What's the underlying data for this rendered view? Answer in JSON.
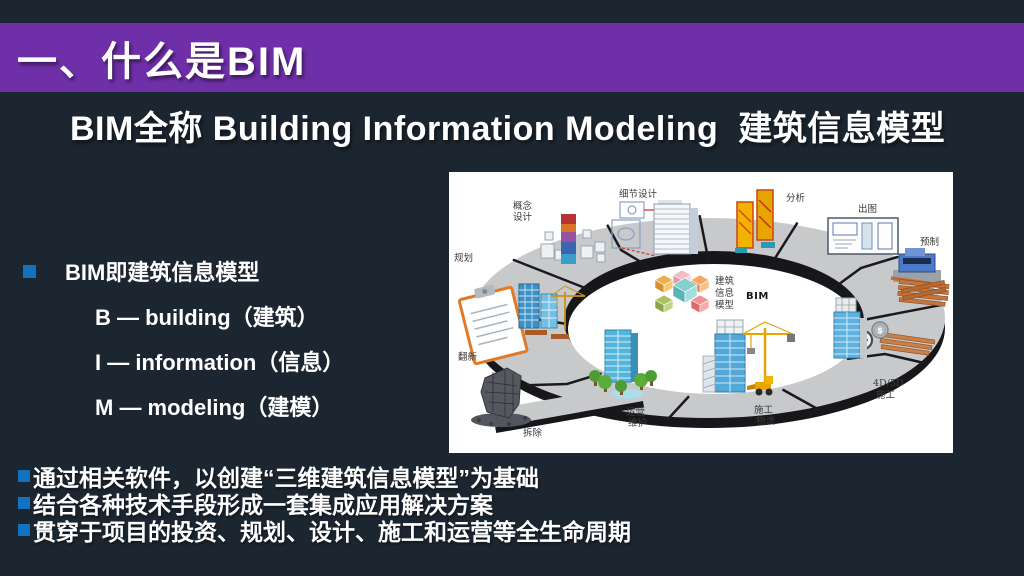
{
  "slide": {
    "title": "一、什么是BIM",
    "subtitle": "BIM全称 Building Information Modeling  建筑信息模型",
    "definition": {
      "heading": "BIM即建筑信息模型",
      "items": [
        "B — building（建筑）",
        "I — information（信息）",
        "M — modeling（建模）"
      ]
    },
    "summary_bullets": [
      "通过相关软件，以创建“三维建筑信息模型”为基础",
      "结合各种技术手段形成一套集成应用解决方案",
      "贯穿于项目的投资、规划、设计、施工和运营等全生命周期"
    ],
    "colors": {
      "header_purple": "#6f2fa8",
      "bullet_blue": "#1272c2",
      "background": "#1c2630"
    }
  },
  "diagram": {
    "description": "BIM lifecycle ring",
    "center": {
      "lines": [
        "建筑",
        "信息",
        "模型"
      ],
      "caption": "BIM"
    },
    "icons": {
      "dollar": "$"
    },
    "stations": [
      {
        "name": "planning",
        "lines": [
          "规划"
        ]
      },
      {
        "name": "concept-design",
        "lines": [
          "概念",
          "设计"
        ]
      },
      {
        "name": "detail-design",
        "lines": [
          "细节设计"
        ]
      },
      {
        "name": "analysis",
        "lines": [
          "分析"
        ]
      },
      {
        "name": "documentation",
        "lines": [
          "出图"
        ]
      },
      {
        "name": "prefabrication",
        "lines": [
          "预制"
        ]
      },
      {
        "name": "construction-4d5d",
        "lines": [
          "4D/5D",
          "施工"
        ]
      },
      {
        "name": "construction-logistics",
        "lines": [
          "施工",
          "物流"
        ]
      },
      {
        "name": "operation-maintenance",
        "lines": [
          "运营",
          "维护"
        ]
      },
      {
        "name": "renovation",
        "lines": [
          "翻新"
        ]
      },
      {
        "name": "demolition",
        "lines": [
          "拆除"
        ]
      }
    ]
  }
}
